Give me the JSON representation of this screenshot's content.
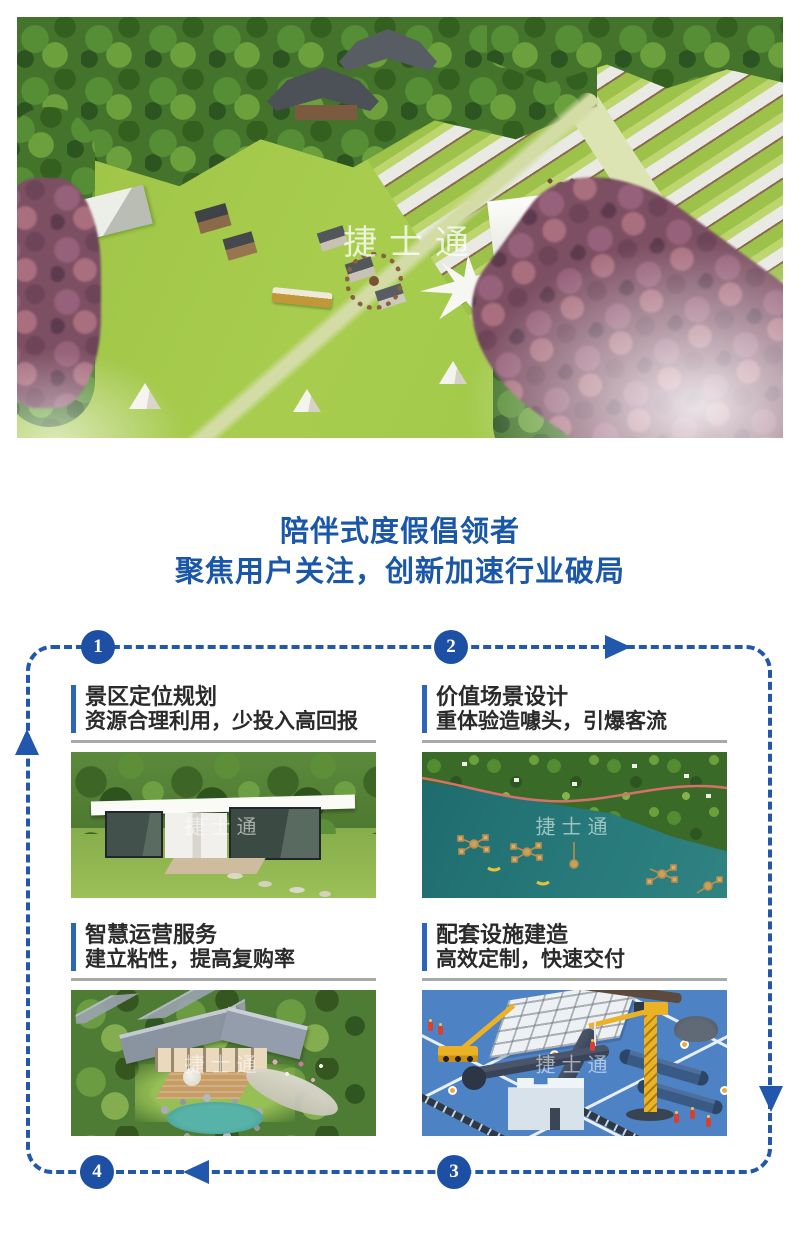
{
  "page": {
    "background": "#ffffff"
  },
  "hero": {
    "description": "aerial-rendering-of-glamping-campground-with-lawn-tents-container-cabins-and-temple",
    "watermark": "捷士通"
  },
  "headline": {
    "line1": "陪伴式度假倡领者",
    "line2": "聚焦用户关注，创新加速行业破局",
    "color": "#1a57a8"
  },
  "flow": {
    "border_color": "#2257ae",
    "circle_color": "#1d50a5",
    "steps": [
      {
        "number": "1"
      },
      {
        "number": "2"
      },
      {
        "number": "3"
      },
      {
        "number": "4"
      }
    ]
  },
  "cards": [
    {
      "title": "景区定位规划",
      "subtitle": "资源合理利用，少投入高回报",
      "image": "modern-white-glass-cabin-on-lawn",
      "watermark": "捷士通"
    },
    {
      "title": "价值场景设计",
      "subtitle": "重体验造噱头，引爆客流",
      "image": "aerial-lake-forest-floating-camps",
      "watermark": "捷士通"
    },
    {
      "title": "智慧运营服务",
      "subtitle": "建立粘性，提高复购率",
      "image": "garden-cottage-with-pond",
      "watermark": "捷士通"
    },
    {
      "title": "配套设施建造",
      "subtitle": "高效定制，快速交付",
      "image": "isometric-construction-site-illustration",
      "watermark": "捷士通"
    }
  ]
}
